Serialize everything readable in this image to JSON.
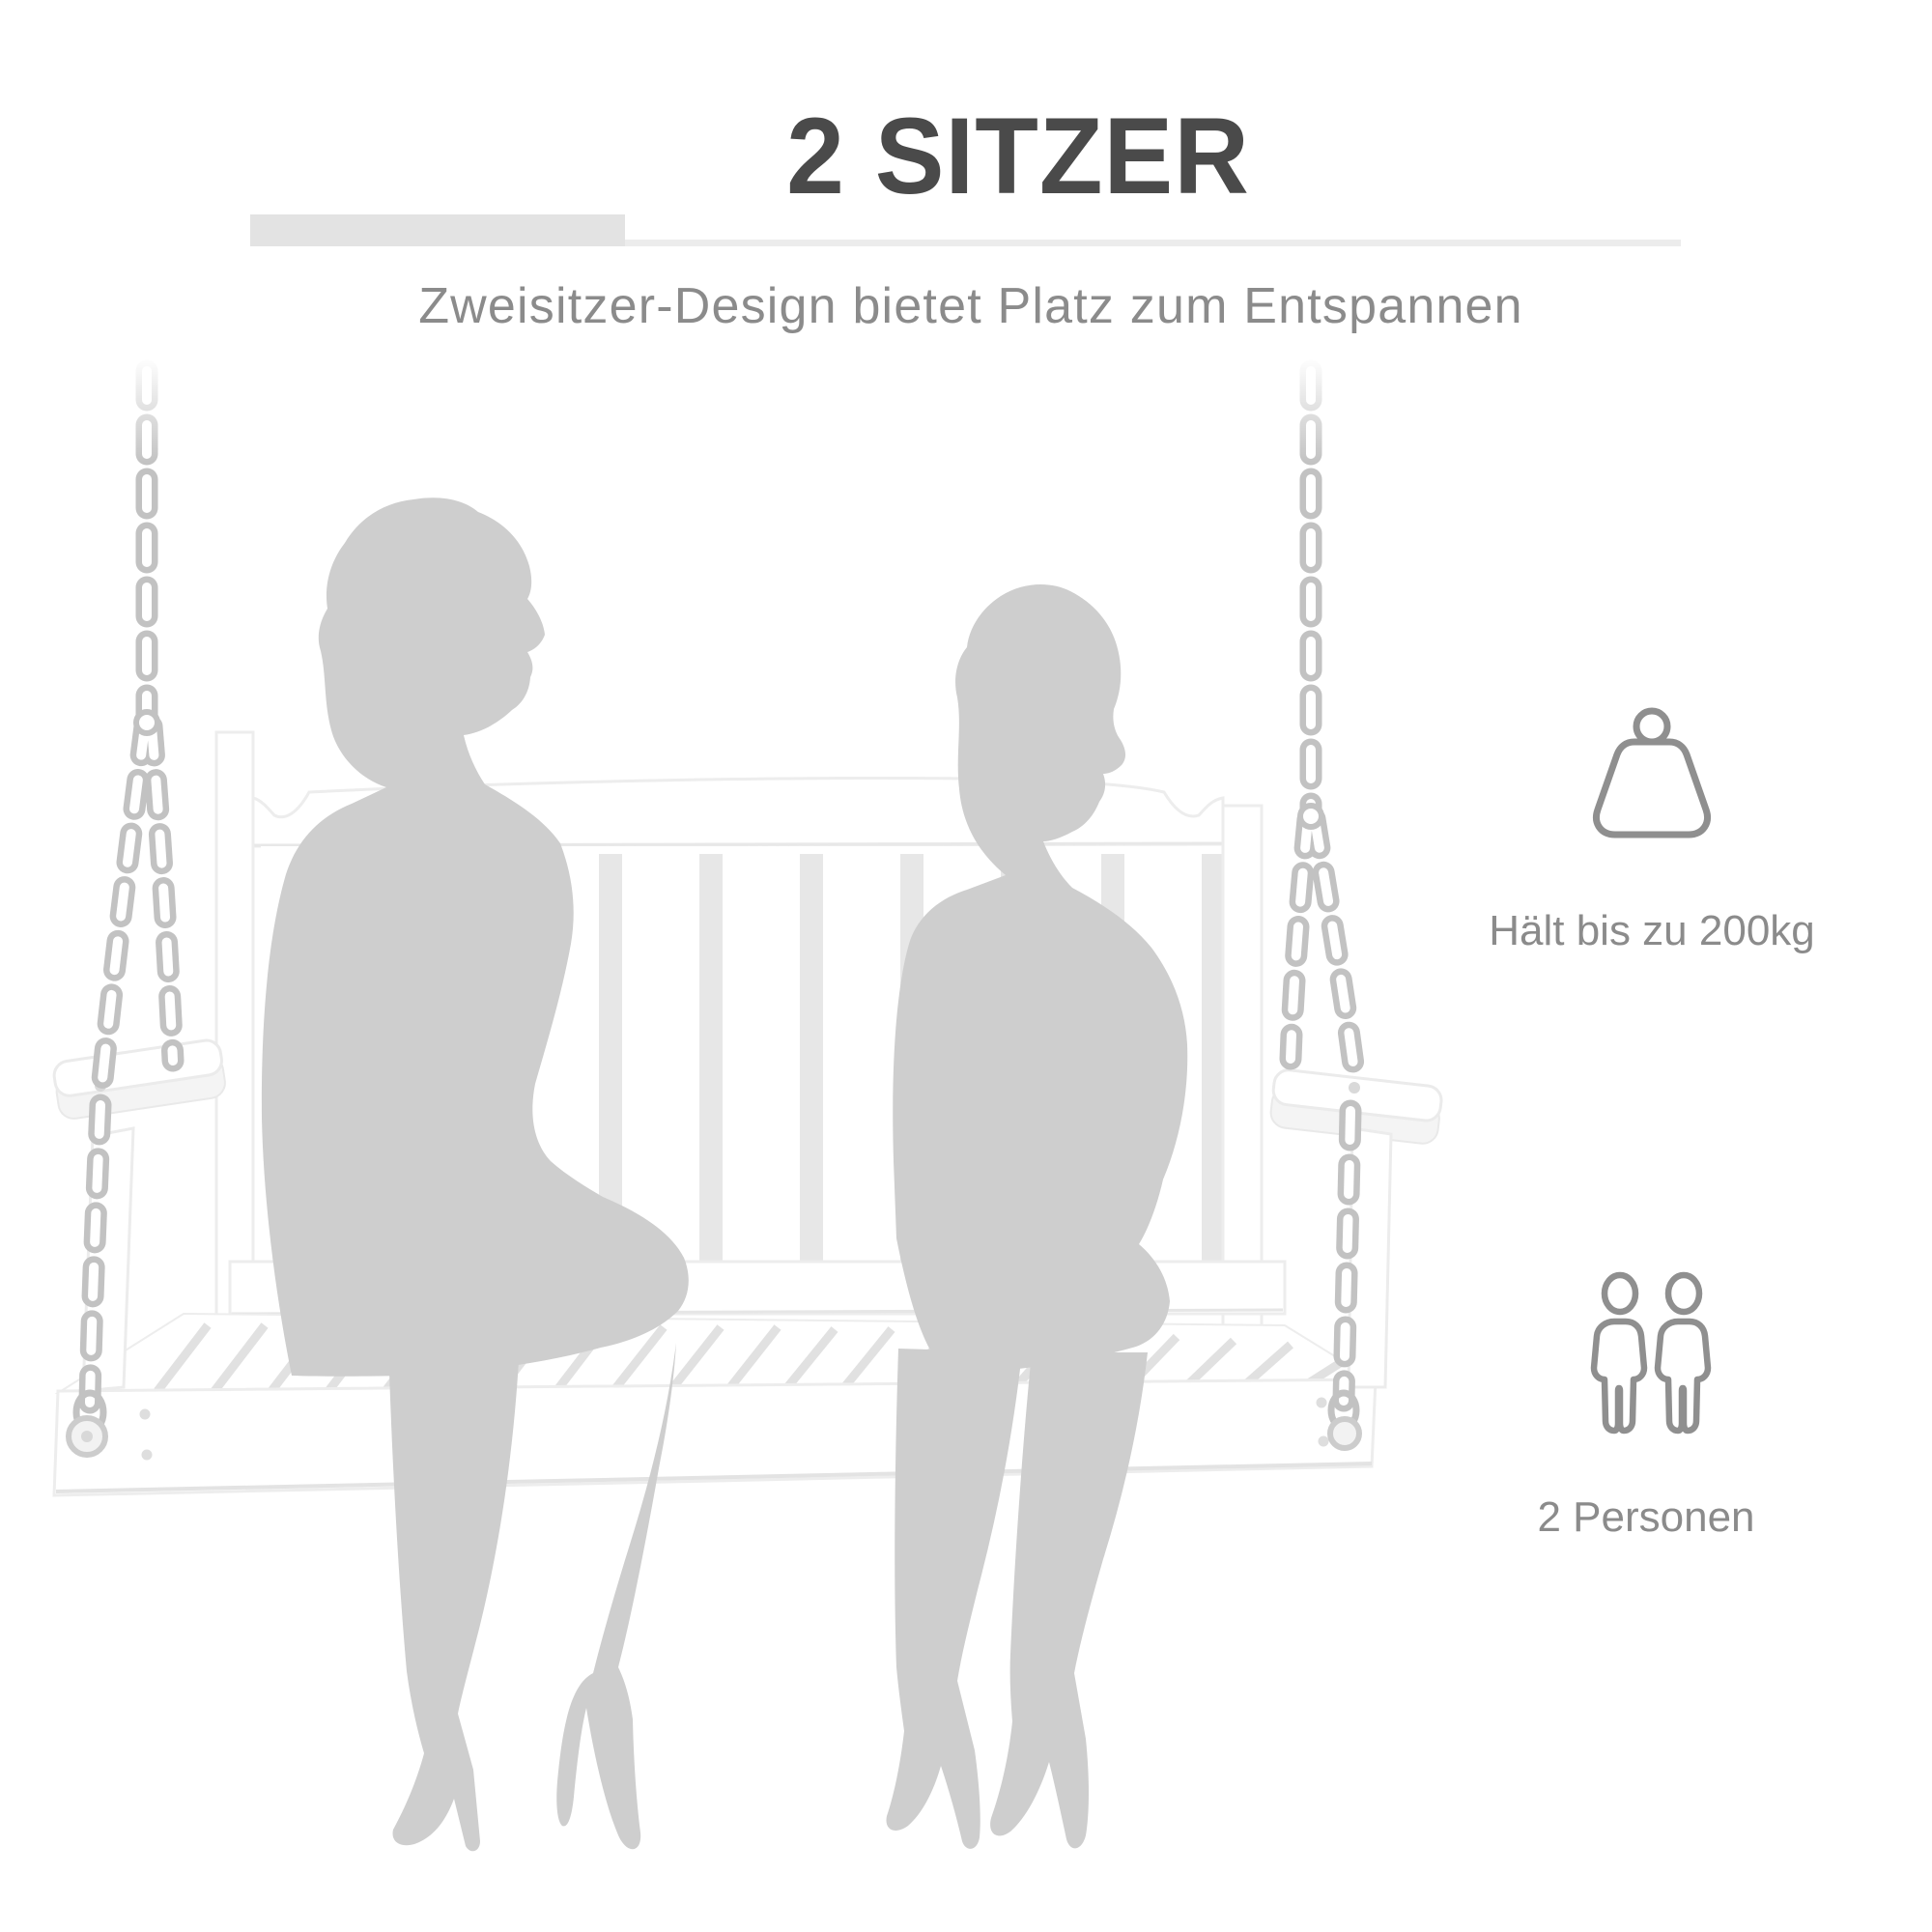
{
  "page": {
    "background_color": "#ffffff",
    "language": "de"
  },
  "header": {
    "title": "2 SITZER",
    "subtitle": "Zweisitzer-Design bietet Platz zum Entspannen",
    "title_color": "#4a4a4a",
    "subtitle_color": "#8b8b8b",
    "underline_thick_color": "#e3e3e3",
    "underline_thin_color": "#ececec"
  },
  "features": [
    {
      "icon": "weight-kettlebell-icon",
      "label": "Hält bis zu 200kg"
    },
    {
      "icon": "two-persons-icon",
      "label": "2 Personen"
    }
  ],
  "illustration": {
    "alt": "Weiße Hollywoodschaukel an Ketten mit zwei grauen Silhouetten sitzender Personen",
    "silhouette_color": "#cecece",
    "chain_color": "#c2c2c2",
    "bench_color": "#ffffff",
    "bench_outline_color": "#ececec",
    "icon_stroke_color": "#8f8f8f"
  }
}
